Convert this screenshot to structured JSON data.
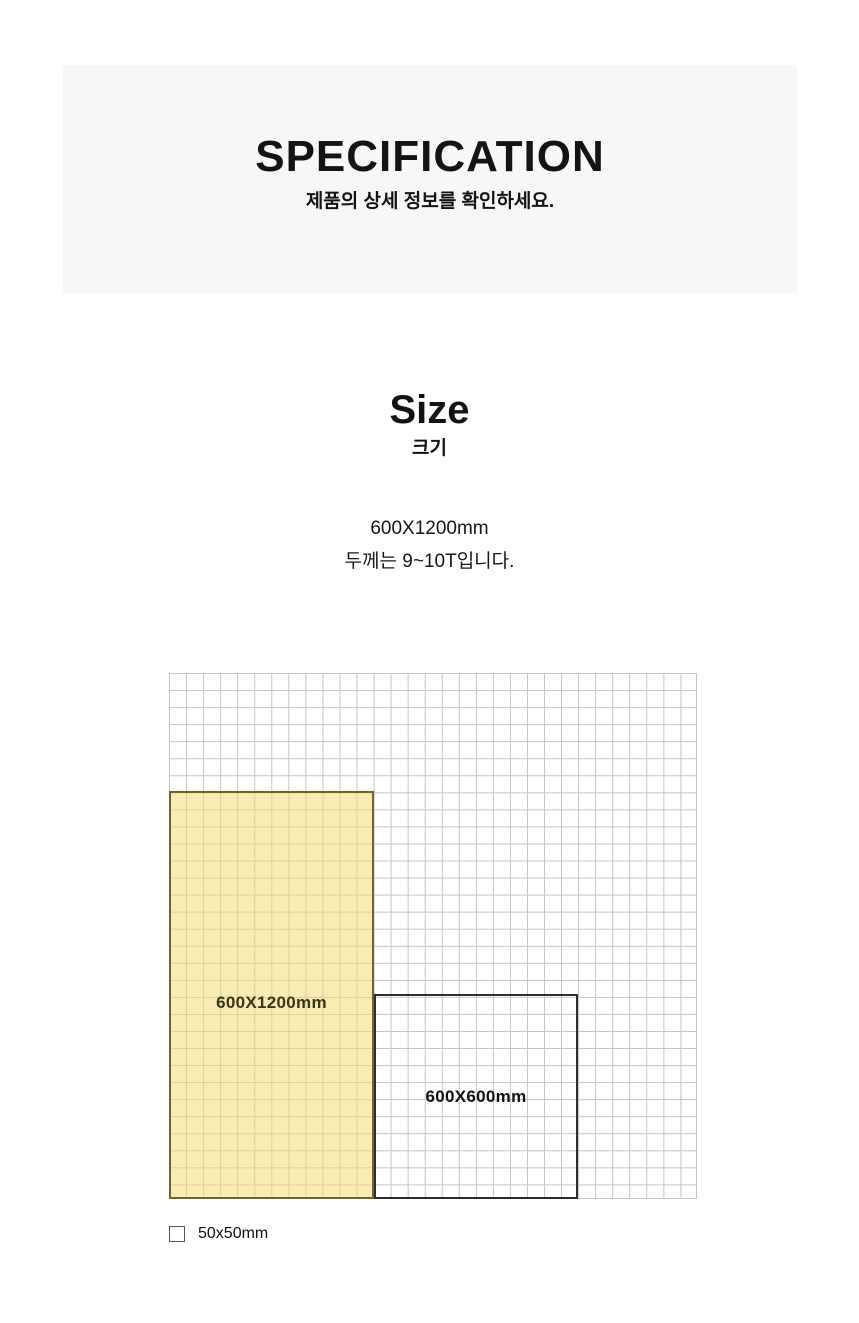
{
  "header": {
    "title": "SPECIFICATION",
    "subtitle": "제품의 상세 정보를 확인하세요.",
    "background_color": "#f7f7f7"
  },
  "size_section": {
    "title": "Size",
    "subtitle_korean": "크기",
    "dimension_text": "600X1200mm",
    "thickness_text": "두께는 9~10T입니다."
  },
  "diagram": {
    "large_rect_label": "600X1200mm",
    "small_rect_label": "600X600mm",
    "legend_label": "50x50mm",
    "grid": {
      "cell_represents": "50x50mm",
      "large_rect_cells": "12 x 24",
      "small_rect_cells": "12 x 12"
    },
    "colors": {
      "grid_line": "#c4c4c4",
      "highlight_fill": "#f6d870",
      "highlight_border": "#6e652e",
      "highlight_label": "#3b3517",
      "outline_rect_border": "#2d2d2d",
      "text": "#111111"
    }
  }
}
